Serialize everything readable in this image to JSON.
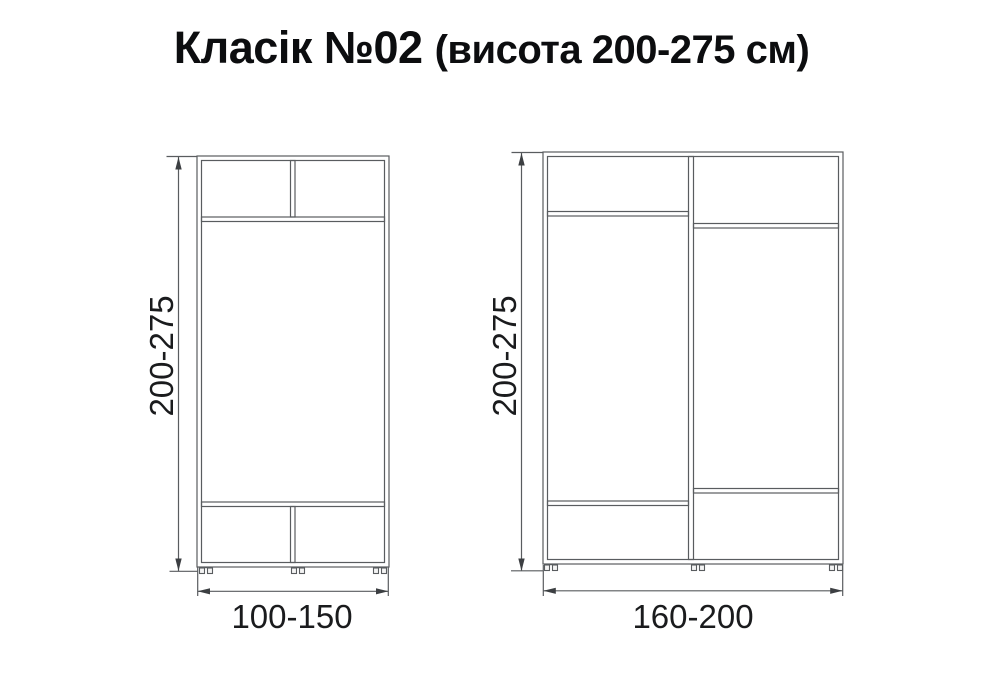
{
  "title": {
    "model": "Класік №02",
    "height_note": "(висота 200-275 см)"
  },
  "units": "см",
  "diagrams": [
    {
      "name": "wardrobe-width-100-150",
      "height_label": "200-275",
      "width_label": "100-150",
      "sections": "2 top compartments, open middle, 2 bottom compartments"
    },
    {
      "name": "wardrobe-width-160-200",
      "height_label": "200-275",
      "width_label": "160-200",
      "sections": "2 columns, each with top compartment, open middle, bottom compartment"
    }
  ],
  "colors": {
    "line": "#595c5f",
    "arrow": "#3c3f42",
    "text": "#1a1b1d",
    "title": "#0c0d0f",
    "background": "#ffffff"
  }
}
